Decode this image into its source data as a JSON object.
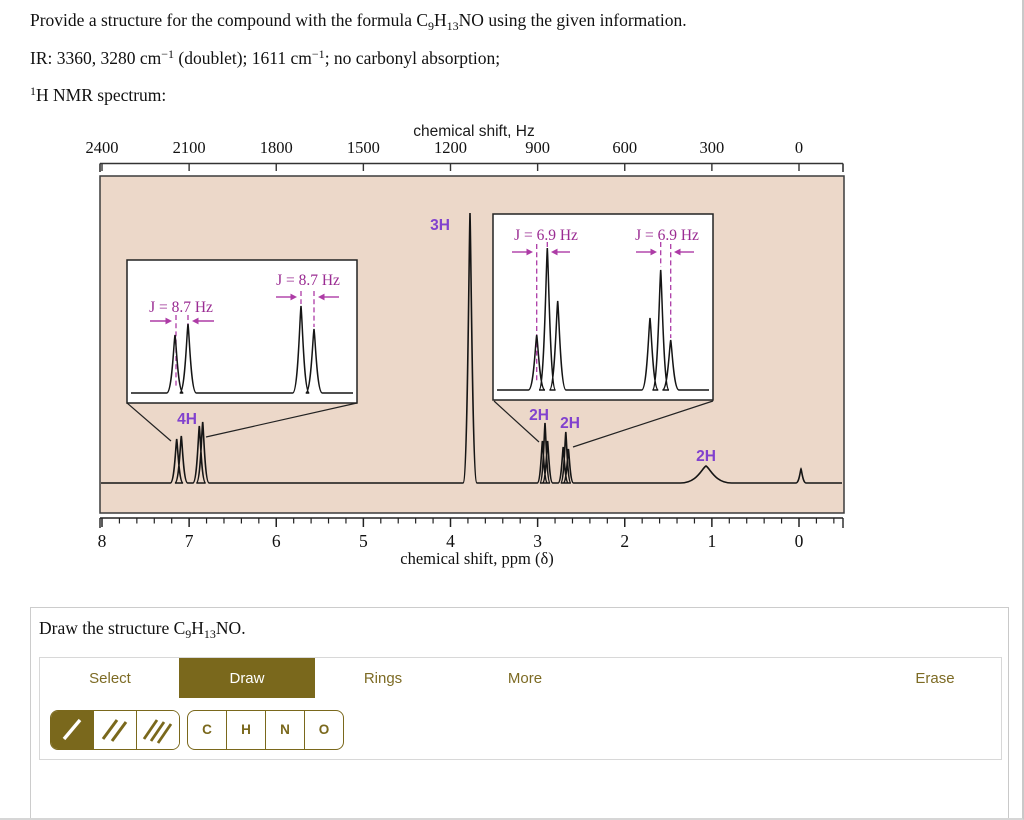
{
  "colors": {
    "plot_background": "#ecd8c9",
    "curve": "#151515",
    "magenta_j": "#9a2b92",
    "violet_integration": "#8141ce",
    "olive_accent": "#7a681c",
    "olive_text": "#7d6b24"
  },
  "question": {
    "l1a": "Provide a structure for the compound with the formula C",
    "l1b": "9",
    "l1c": "H",
    "l1d": "13",
    "l1e": "NO using the given information.",
    "l2a": "IR: 3360, 3280 cm",
    "l2b": "−1",
    "l2c": " (doublet); 1611 cm",
    "l2d": "−1",
    "l2e": "; no carbonyl absorption;",
    "l3a": "1",
    "l3b": "H NMR spectrum:"
  },
  "figure": {
    "hz_axis": {
      "label": "chemical shift, Hz",
      "ticks": [
        "2400",
        "2100",
        "1800",
        "1500",
        "1200",
        "900",
        "600",
        "300",
        "0"
      ]
    },
    "ppm_axis": {
      "label": "chemical shift, ppm (δ)",
      "ticks": [
        "8",
        "7",
        "6",
        "5",
        "4",
        "3",
        "2",
        "1",
        "0"
      ]
    },
    "peak_labels": [
      "3H",
      "4H",
      "2H",
      "2H",
      "2H"
    ],
    "j_labels": [
      "J = 8.7 Hz",
      "J = 8.7 Hz",
      "J = 6.9 Hz",
      "J = 6.9 Hz"
    ]
  },
  "chart_data": {
    "type": "line",
    "title": "1H NMR spectrum",
    "x_axis_top": {
      "label": "chemical shift, Hz",
      "ticks": [
        2400,
        2100,
        1800,
        1500,
        1200,
        900,
        600,
        300,
        0
      ]
    },
    "x_axis_bottom": {
      "label": "chemical shift, ppm (δ)",
      "ticks": [
        8,
        7,
        6,
        5,
        4,
        3,
        2,
        1,
        0
      ],
      "direction": "decreasing"
    },
    "peaks": [
      {
        "ppm": 7.1,
        "integration": "4H",
        "pattern": "two doublets",
        "J_Hz": 8.7
      },
      {
        "ppm": 6.87,
        "integration": "part of 4H",
        "pattern": "doublet",
        "J_Hz": 8.7
      },
      {
        "ppm": 3.77,
        "integration": "3H",
        "pattern": "singlet"
      },
      {
        "ppm": 2.91,
        "integration": "2H",
        "pattern": "triplet",
        "J_Hz": 6.9
      },
      {
        "ppm": 2.67,
        "integration": "2H",
        "pattern": "triplet",
        "J_Hz": 6.9
      },
      {
        "ppm": 1.07,
        "integration": "2H",
        "pattern": "broad singlet"
      },
      {
        "ppm": 0.0,
        "integration": "",
        "pattern": "reference singlet"
      }
    ],
    "insets": [
      {
        "region_ppm": [
          7.3,
          6.7
        ],
        "J_Hz": [
          8.7,
          8.7
        ]
      },
      {
        "region_ppm": [
          3.1,
          2.4
        ],
        "J_Hz": [
          6.9,
          6.9
        ]
      }
    ]
  },
  "panel": {
    "prompt_a": "Draw the structure C",
    "prompt_b": "9",
    "prompt_c": "H",
    "prompt_d": "13",
    "prompt_e": "NO.",
    "tabs": [
      {
        "label": "Select",
        "active": false
      },
      {
        "label": "Draw",
        "active": true
      },
      {
        "label": "Rings",
        "active": false
      },
      {
        "label": "More",
        "active": false
      },
      {
        "label": "Erase",
        "active": false
      }
    ],
    "bond_tools": [
      {
        "name": "single-bond",
        "selected": true
      },
      {
        "name": "double-bond",
        "selected": false
      },
      {
        "name": "triple-bond",
        "selected": false
      }
    ],
    "atom_buttons": [
      "C",
      "H",
      "N",
      "O"
    ]
  }
}
